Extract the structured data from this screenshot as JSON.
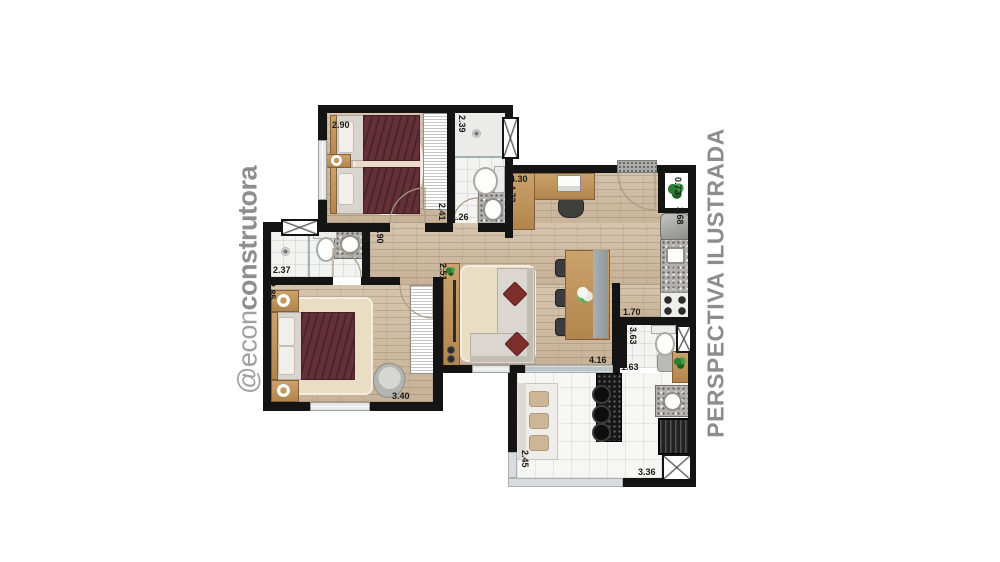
{
  "watermark": {
    "prefix": "@econ",
    "suffix": "construtora"
  },
  "caption": "PERSPECTIVA ILUSTRADA",
  "dims": [
    {
      "room": "bedroom-2-width",
      "value": "2.90"
    },
    {
      "room": "bathroom-1-width",
      "value": "2.39"
    },
    {
      "room": "hall-length",
      "value": "2.41"
    },
    {
      "room": "bathroom-1-length",
      "value": "1.26"
    },
    {
      "room": "hall-width",
      "value": "0.90"
    },
    {
      "room": "bathroom-2-depth",
      "value": "1.21"
    },
    {
      "room": "bathroom-2-width",
      "value": "2.37"
    },
    {
      "room": "master-bedroom-depth",
      "value": "2.85"
    },
    {
      "room": "living-tv-wall",
      "value": "2.51"
    },
    {
      "room": "entry-width",
      "value": "4.30"
    },
    {
      "room": "living-length",
      "value": "4.72"
    },
    {
      "room": "niche-width",
      "value": "0.73"
    },
    {
      "room": "kitchen-width",
      "value": "2.68"
    },
    {
      "room": "lavatory-width",
      "value": "1.70"
    },
    {
      "room": "lavatory-length",
      "value": "3.63"
    },
    {
      "room": "living-bottom-width",
      "value": "4.16"
    },
    {
      "room": "balcony-right-width",
      "value": "1.63"
    },
    {
      "room": "master-bedroom-width",
      "value": "3.40"
    },
    {
      "room": "balcony-depth",
      "value": "2.45"
    },
    {
      "room": "balcony-width",
      "value": "3.36"
    }
  ],
  "colors": {
    "wall": "#141414",
    "wood_floor": "#cfbca4",
    "tile_floor": "#f3f3f1",
    "bed_blanket": "#643139",
    "granite": "#b3b2af",
    "bar_counter": "#161616",
    "furniture_wood": "#c49a64",
    "watermark_gray": "#9c9c9c"
  }
}
